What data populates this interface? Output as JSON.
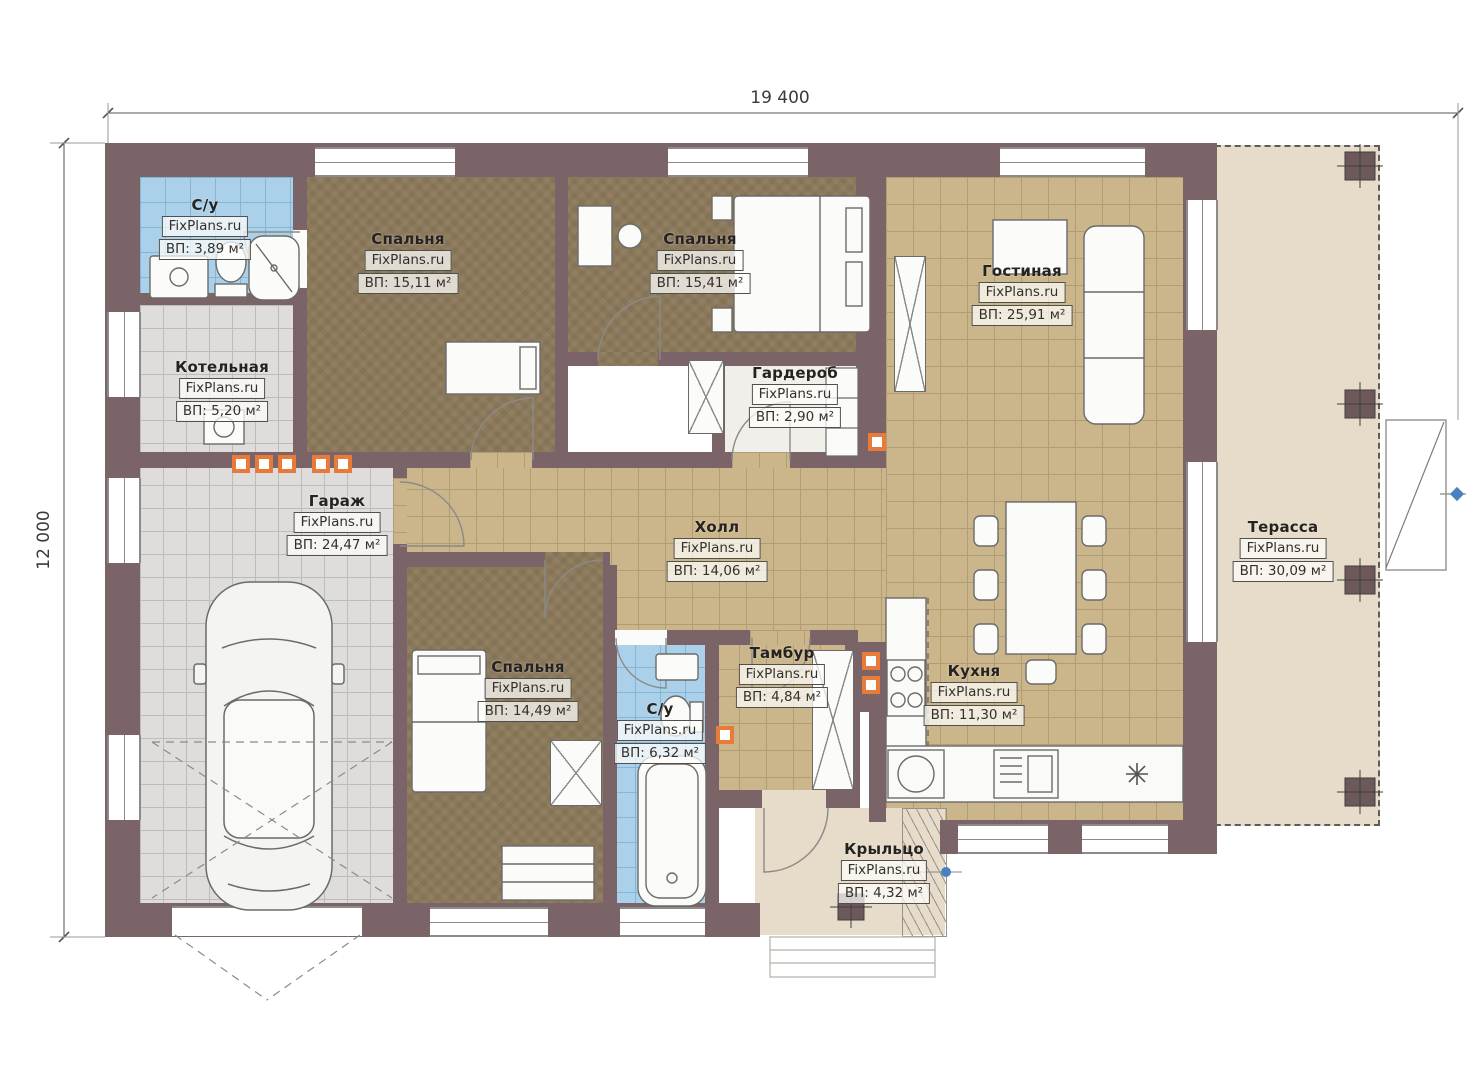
{
  "dimensions": {
    "top": "19 400",
    "left": "12 000"
  },
  "watermark": "FixPlans.ru",
  "rooms": [
    {
      "name": "С/у",
      "watermark": "FixPlans.ru",
      "area": "ВП: 3,89 м²"
    },
    {
      "name": "Спальня",
      "watermark": "FixPlans.ru",
      "area": "ВП: 15,11 м²"
    },
    {
      "name": "Спальня",
      "watermark": "FixPlans.ru",
      "area": "ВП: 15,41 м²"
    },
    {
      "name": "Гостиная",
      "watermark": "FixPlans.ru",
      "area": "ВП: 25,91 м²"
    },
    {
      "name": "Котельная",
      "watermark": "FixPlans.ru",
      "area": "ВП: 5,20 м²"
    },
    {
      "name": "Гардероб",
      "watermark": "FixPlans.ru",
      "area": "ВП: 2,90 м²"
    },
    {
      "name": "Гараж",
      "watermark": "FixPlans.ru",
      "area": "ВП: 24,47 м²"
    },
    {
      "name": "Холл",
      "watermark": "FixPlans.ru",
      "area": "ВП: 14,06 м²"
    },
    {
      "name": "Терасса",
      "watermark": "FixPlans.ru",
      "area": "ВП: 30,09 м²"
    },
    {
      "name": "Спальня",
      "watermark": "FixPlans.ru",
      "area": "ВП: 14,49 м²"
    },
    {
      "name": "С/у",
      "watermark": "FixPlans.ru",
      "area": "ВП: 6,32 м²"
    },
    {
      "name": "Тамбур",
      "watermark": "FixPlans.ru",
      "area": "ВП: 4,84 м²"
    },
    {
      "name": "Кухня",
      "watermark": "FixPlans.ru",
      "area": "ВП: 11,30 м²"
    },
    {
      "name": "Крыльцо",
      "watermark": "FixPlans.ru",
      "area": "ВП: 4,32 м²"
    }
  ],
  "colors": {
    "wall": "#7b6468",
    "tan": "#cbb58a",
    "tan_grid": "#b29c73",
    "gray": "#dedddb",
    "gray_grid": "#bcbcba",
    "blue": "#abd1ea",
    "blue_grid": "#84b6d6",
    "brown": "#8c795b",
    "beige": "#e6dcc9",
    "accent": "#e87a3a",
    "marker_blue": "#4a7fc1"
  }
}
